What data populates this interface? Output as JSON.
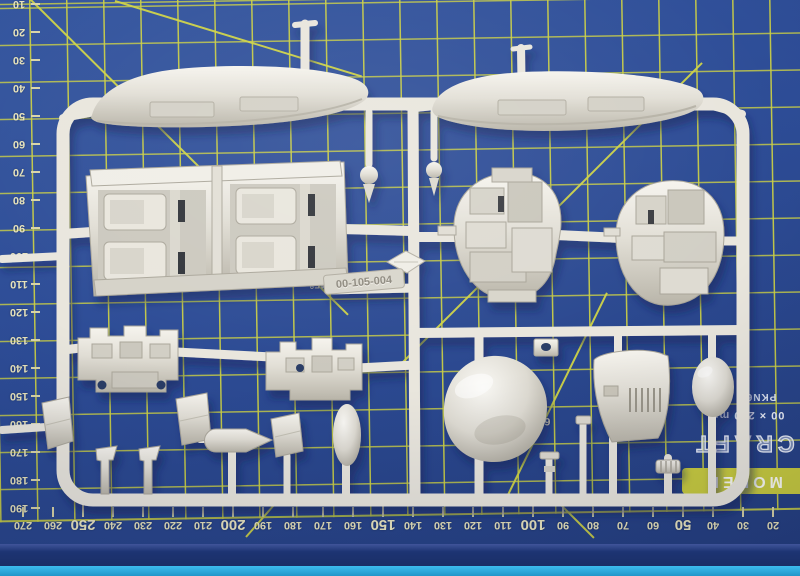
{
  "scene": {
    "alt": "White model kit sprue with aircraft parts lying on a blue self-healing cutting mat"
  },
  "mat": {
    "surface_color": "#2d4c96",
    "grid_color": "#ccd043",
    "edge_dark_color": "#1d3473",
    "edge_cyan_color": "#2ba8dc",
    "label_color": "#e7e3bb",
    "angle_labels": {
      "left_45": "45°",
      "right_45": "45°",
      "sixty": "60°"
    },
    "brand": {
      "name_bar": "MODEL",
      "name_top": "CRAFT",
      "size_text": "00 × 220 mm",
      "code_text": "PKN6"
    },
    "bottom_ruler": {
      "numbers": [
        270,
        260,
        250,
        240,
        230,
        220,
        210,
        200,
        190,
        180,
        170,
        160,
        150,
        140,
        130,
        120,
        110,
        100,
        90,
        80,
        70,
        60,
        50,
        40,
        30,
        20
      ]
    },
    "left_ruler": {
      "numbers": [
        10,
        20,
        30,
        40,
        50,
        60,
        70,
        80,
        90,
        100,
        110,
        120,
        130,
        140,
        150,
        160,
        170,
        180,
        190
      ]
    }
  },
  "sprue": {
    "plastic_color": "#e9e6dd",
    "tag_label": "00-105-004",
    "parts": [
      "nacelle-half-left",
      "nacelle-half-right",
      "cockpit-tub-assembly",
      "engine-detail-left",
      "engine-detail-right",
      "instrument-panel-left",
      "instrument-panel-right",
      "nose-dome",
      "cowling-panel",
      "egg-fairing",
      "flap-small-1",
      "flap-small-2",
      "flap-small-3",
      "spinner",
      "seat-column-1",
      "seat-column-2",
      "oval-tank",
      "ball-joint-1",
      "ball-joint-2",
      "diamond-vane",
      "vented-plate",
      "small-cylinder",
      "ribbed-cap"
    ]
  }
}
